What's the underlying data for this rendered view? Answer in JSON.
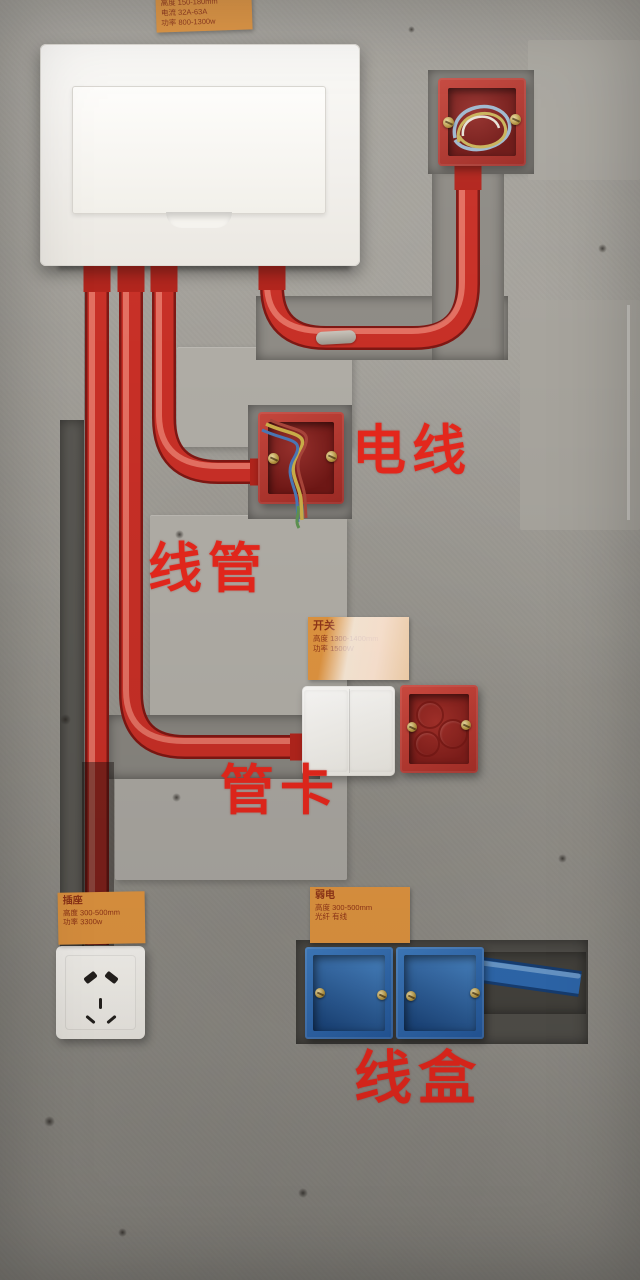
{
  "annotations": {
    "wire": "电线",
    "conduit": "线管",
    "pipe_clamp": "管卡",
    "wire_box": "线盒"
  },
  "stickers": {
    "panel": {
      "line1": "高度 150-180mm",
      "line2": "电流 32A-63A",
      "line3": "功率 800-1300w"
    },
    "switch": {
      "title": "开关",
      "line1": "高度 1300-1400mm",
      "line2": "功率 1500W"
    },
    "socket": {
      "title": "插座",
      "line1": "高度 300-500mm",
      "line2": "功率 3300w"
    },
    "weak_current": {
      "title": "弱电",
      "line1": "高度 300-500mm",
      "line2": "光纤 有线"
    }
  },
  "palette": {
    "wall_grey": "#9d9a93",
    "conduit_red": "#c72f26",
    "junction_box_red": "#b5382f",
    "wire_box_blue": "#2e67ab",
    "device_white": "#f4f2ee",
    "sticker_orange": "#df9440",
    "sticker_text": "#8f3417",
    "annotation_red": "#e5271c"
  }
}
